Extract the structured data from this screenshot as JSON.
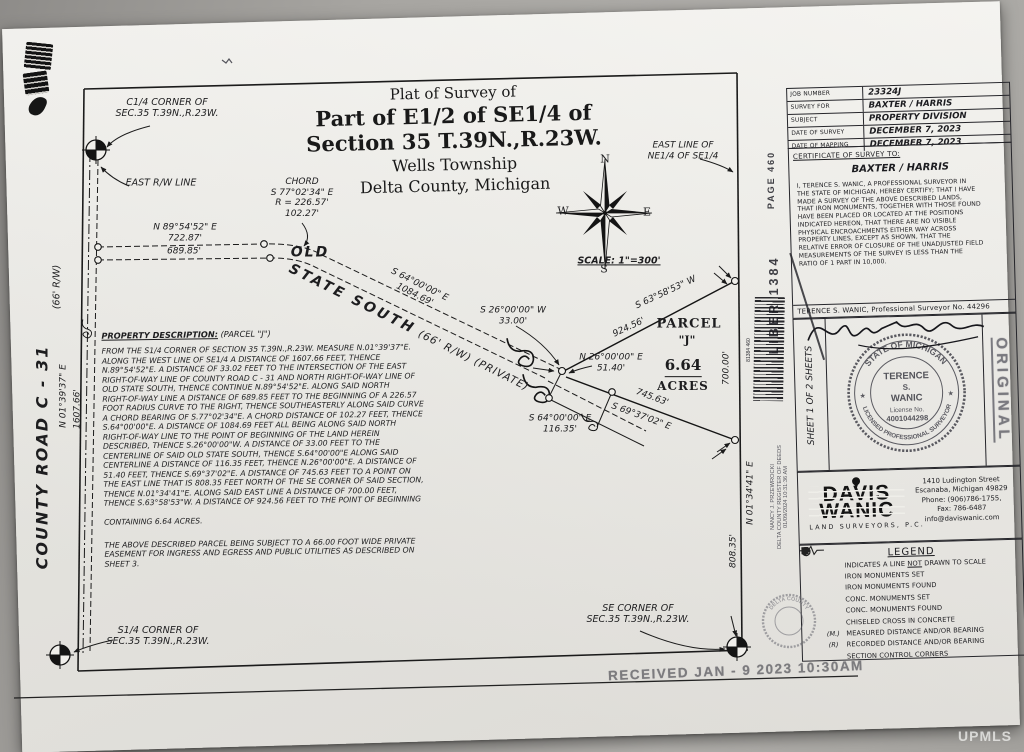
{
  "watermark": "UPMLS",
  "title_block": {
    "line1": "Plat of Survey of",
    "line2": "Part of  E1/2 of SE1/4 of",
    "line3": "Section 35 T.39N.,R.23W.",
    "line4": "Wells Township",
    "line5": "Delta County, Michigan"
  },
  "compass": {
    "n": "N",
    "s": "S",
    "e": "E",
    "w": "W",
    "scale": "SCALE: 1\"=300'"
  },
  "map_labels": {
    "c14_corner": "C1/4 CORNER OF\nSEC.35 T.39N.,R.23W.",
    "east_rw": "EAST R/W LINE",
    "bearing_n8954": "N 89°54'52\" E\n722.87'",
    "dist_68985": "689.85'",
    "old": "OLD",
    "state_south_big": "STATE SOUTH",
    "state_south_small": "(66' R/W) (PRIVATE)",
    "chord": "CHORD\nS 77°02'34\" E\nR = 226.57'\n102.27'",
    "bearing_s64_road": "S 64°00'00\" E\n1084.69'",
    "bearing_s26": "S 26°00'00\" W\n33.00'",
    "bearing_n26": "N 26°00'00\" E\n51.40'",
    "bearing_s64_cl": "S 64°00'00\" E\n116.35'",
    "bearing_s6358": "S 63°58'53\" W",
    "dist_92456": "924.56'",
    "dist_74563": "745.63'",
    "bearing_s6937": "S 69°37'02\" E",
    "dist_70000": "700.00'",
    "bearing_n0134": "N 01°34'41\" E",
    "dist_80835": "808.35'",
    "east_line_label": "EAST LINE OF\nNE1/4 OF SE1/4",
    "county_road": "COUNTY ROAD C - 31",
    "county_rw": "(66' R/W)",
    "bearing_n0139": "N 01°39'37\" E",
    "dist_160766": "1607.66'",
    "s14_corner": "S1/4 CORNER OF\nSEC.35 T.39N.,R.23W.",
    "se_corner": "SE CORNER OF\nSEC.35 T.39N.,R.23W."
  },
  "parcel": {
    "name_line1": "PARCEL",
    "name_line2": "\"J\"",
    "acreage": "6.64",
    "acreage_unit": "ACRES"
  },
  "description": {
    "heading": "PROPERTY DESCRIPTION:",
    "heading_suffix": " (PARCEL \"J\")",
    "body": "FROM THE S1/4 CORNER OF SECTION 35 T.39N.,R.23W. MEASURE N.01°39'37\"E.\nALONG THE WEST LINE OF SE1/4 A DISTANCE OF 1607.66 FEET, THENCE\nN.89°54'52\"E. A DISTANCE OF 33.02 FEET TO THE INTERSECTION OF THE EAST\nRIGHT-OF-WAY LINE OF COUNTY ROAD C - 31 AND NORTH RIGHT-OF-WAY LINE OF\nOLD STATE SOUTH, THENCE CONTINUE N.89°54'52\"E. ALONG SAID NORTH\nRIGHT-OF-WAY LINE A DISTANCE OF 689.85 FEET TO THE BEGINNING OF A 226.57\nFOOT RADIUS CURVE TO THE RIGHT, THENCE SOUTHEASTERLY ALONG SAID CURVE\nA CHORD BEARING OF S.77°02'34\"E. A CHORD DISTANCE OF 102.27 FEET, THENCE\nS.64°00'00\"E. A DISTANCE OF 1084.69 FEET ALL BEING ALONG SAID NORTH\nRIGHT-OF-WAY LINE TO THE POINT OF BEGINNING OF THE LAND HEREIN\nDESCRIBED, THENCE S.26°00'00\"W. A DISTANCE OF 33.00 FEET TO THE\nCENTERLINE OF SAID OLD STATE SOUTH, THENCE S.64°00'00\"E ALONG SAID\nCENTERLINE A DISTANCE OF 116.35 FEET, THENCE N.26°00'00\"E. A DISTANCE OF\n51.40 FEET, THENCE S.69°37'02\"E. A DISTANCE OF 745.63 FEET TO A POINT ON\nTHE EAST LINE THAT IS 808.35 FEET NORTH OF THE SE CORNER OF SAID SECTION,\nTHENCE N.01°34'41\"E. ALONG SAID EAST LINE A DISTANCE OF 700.00 FEET,\nTHENCE S.63°58'53\"W. A DISTANCE OF 924.56 FEET TO THE POINT OF BEGINNING",
    "containing": "CONTAINING 6.64 ACRES.",
    "easement": "THE ABOVE DESCRIBED PARCEL BEING SUBJECT TO A 66.00 FOOT WIDE PRIVATE\nEASEMENT FOR INGRESS AND EGRESS AND PUBLIC UTILITIES AS DESCRIBED ON\nSHEET 3."
  },
  "info_table": {
    "rows": [
      {
        "label": "JOB NUMBER",
        "value": "23324J"
      },
      {
        "label": "SURVEY FOR",
        "value": "BAXTER / HARRIS"
      },
      {
        "label": "SUBJECT",
        "value": "PROPERTY DIVISION"
      },
      {
        "label": "DATE OF SURVEY",
        "value": "DECEMBER 7, 2023"
      },
      {
        "label": "DATE OF MAPPING",
        "value": "DECEMBER 7, 2023"
      }
    ]
  },
  "certificate": {
    "heading": "CERTIFICATE OF SURVEY TO:",
    "names": "BAXTER / HARRIS",
    "body": "I, TERENCE S. WANIC, A PROFESSIONAL SURVEYOR IN\nTHE STATE OF MICHIGAN, HEREBY CERTIFY; THAT I HAVE\nMADE A SURVEY OF THE ABOVE DESCRIBED LANDS,\nTHAT IRON MONUMENTS, TOGETHER WITH THOSE FOUND\nHAVE BEEN PLACED OR LOCATED AT THE POSITIONS\nINDICATED HEREON, THAT THERE ARE NO VISIBLE\nPHYSICAL ENCROACHMENTS EITHER WAY ACROSS\nPROPERTY LINES, EXCEPT AS SHOWN, THAT THE\nRELATIVE ERROR OF CLOSURE OF THE UNADJUSTED FIELD\nMEASUREMENTS OF THE SURVEY IS LESS THAN THE\nRATIO OF 1 PART IN 10,000.",
    "surveyor_line": "TERENCE S. WANIC, Professional Surveyor No. 44296"
  },
  "seal": {
    "sheet_note": "SHEET 1 OF 2 SHEETS",
    "arc_top": "STATE OF MICHIGAN",
    "arc_bottom": "LICENSED PROFESSIONAL SURVEYOR",
    "name1": "TERENCE",
    "name2": "S.",
    "name3": "WANIC",
    "license_label": "License No.",
    "license_no": "4001044298",
    "original": "ORIGINAL"
  },
  "firm": {
    "logo_line1": "DAVIS",
    "logo_line2": "WANIC",
    "sub": "LAND SURVEYORS, P.C.",
    "address": "1410 Ludington Street\nEscanaba, Michigan 49829\nPhone: (906)786-1755,\nFax: 786-6487\ninfo@daviswanic.com"
  },
  "legend": {
    "heading": "LEGEND",
    "items": [
      {
        "sym": "break",
        "text": "INDICATES A LINE NOT DRAWN TO SCALE",
        "underline_word": "NOT"
      },
      {
        "sym": "circle_open",
        "text": "IRON MONUMENTS SET"
      },
      {
        "sym": "circle_filled",
        "text": "IRON MONUMENTS FOUND"
      },
      {
        "sym": "square_open",
        "text": "CONC. MONUMENTS SET"
      },
      {
        "sym": "square_filled",
        "text": "CONC. MONUMENTS FOUND"
      },
      {
        "sym": "circle_cross",
        "text": "CHISELED CROSS IN CONCRETE"
      },
      {
        "sym_text": "(M.)",
        "text": "MEASURED DISTANCE AND/OR BEARING"
      },
      {
        "sym_text": "(R)",
        "text": "RECORDED DISTANCE AND/OR BEARING"
      },
      {
        "sym": "section",
        "text": "SECTION CONTROL CORNERS"
      }
    ]
  },
  "stamps": {
    "liber": "LIBER 1384",
    "page": "PAGE 460",
    "register_line1": "NANCY J. PRZEWROCKI",
    "register_line2": "DELTA COUNTY REGISTER OF DEEDS",
    "register_line3": "01/09/2024 10:31:36 AM",
    "received": "RECEIVED  JAN - 9 2023  10:30AM",
    "barcode_digits": "81384 460",
    "delta_seal": "DELTA COUNTY"
  }
}
